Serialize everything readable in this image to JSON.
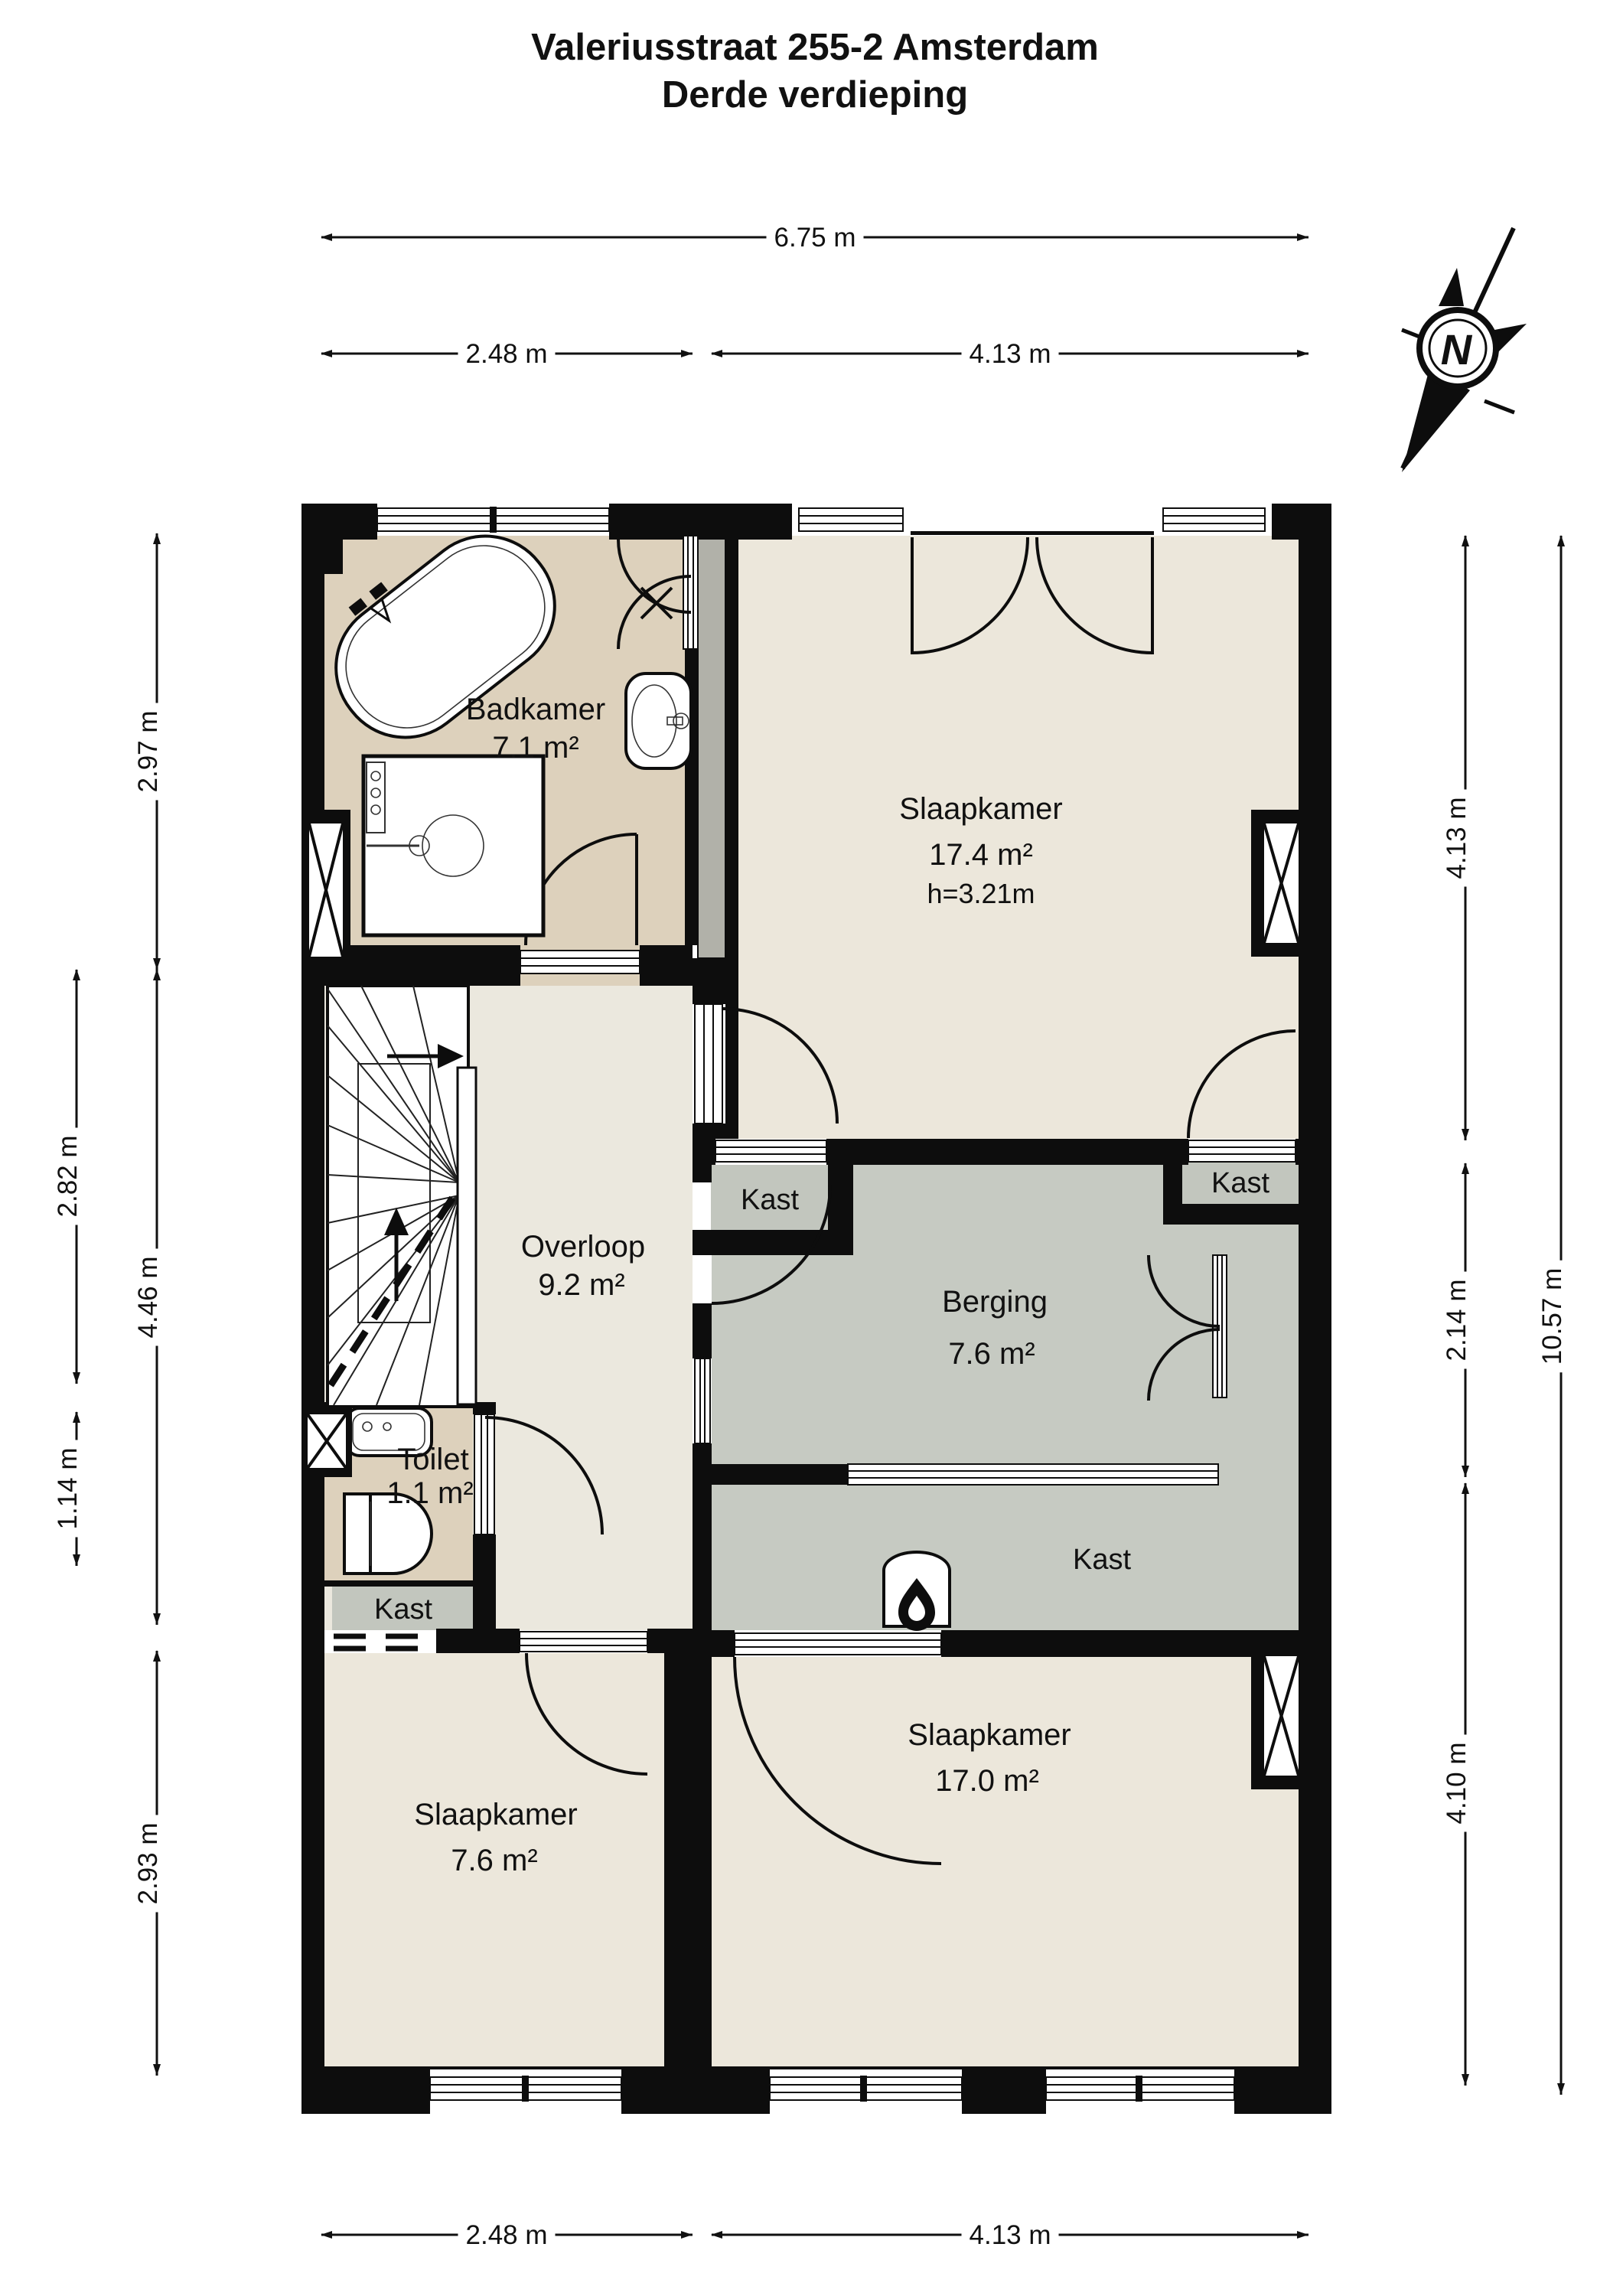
{
  "title": {
    "line1": "Valeriusstraat 255-2 Amsterdam",
    "line2": "Derde verdieping"
  },
  "compass": {
    "north_label": "N"
  },
  "rooms": {
    "badkamer": {
      "name": "Badkamer",
      "area": "7.1 m²"
    },
    "slaapkamer_top": {
      "name": "Slaapkamer",
      "area": "17.4 m²",
      "ceiling_height": "h=3.21m"
    },
    "overloop": {
      "name": "Overloop",
      "area": "9.2 m²"
    },
    "berging": {
      "name": "Berging",
      "area": "7.6 m²"
    },
    "toilet": {
      "name": "Toilet",
      "area": "1.1 m²"
    },
    "slaapkamer_left": {
      "name": "Slaapkamer",
      "area": "7.6 m²"
    },
    "slaapkamer_right": {
      "name": "Slaapkamer",
      "area": "17.0 m²"
    },
    "kast_top_left": {
      "name": "Kast"
    },
    "kast_top_right": {
      "name": "Kast"
    },
    "kast_bottom_left": {
      "name": "Kast"
    },
    "kast_berging": {
      "name": "Kast"
    }
  },
  "dimensions": {
    "top_total": "6.75 m",
    "top_left_seg": "2.48 m",
    "top_right_seg": "4.13 m",
    "bottom_left_seg": "2.48 m",
    "bottom_right_seg": "4.13 m",
    "left_top": "2.97 m",
    "left_mid": "4.46 m",
    "left_bottom": "2.93 m",
    "left_outer_top": "2.82 m",
    "left_outer_bottom": "1.14 m",
    "right_top": "4.13 m",
    "right_mid": "2.14 m",
    "right_bottom": "4.10 m",
    "right_total": "10.57 m"
  },
  "colors": {
    "wall": "#0d0d0d",
    "bedroom_fill": "#ece7db",
    "bathroom_fill": "#ddd1bc",
    "storage_fill": "#c6cac2",
    "hall_fill": "#ebe8de",
    "closet_fill": "#c2c6be",
    "shaft_fill": "#b1b1a9",
    "background": "#ffffff"
  }
}
